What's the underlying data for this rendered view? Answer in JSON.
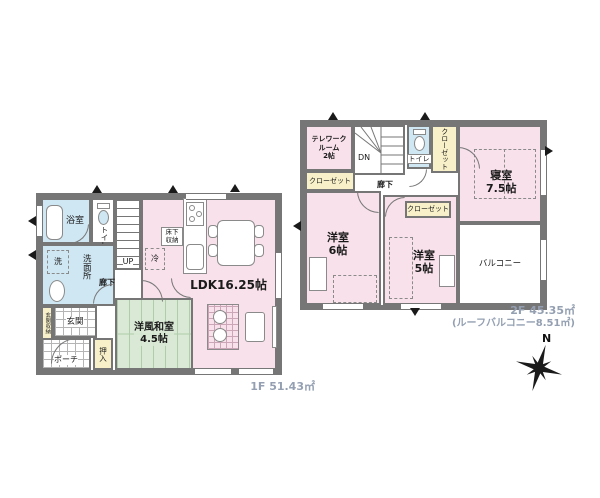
{
  "colors": {
    "wall": "#767676",
    "room_pink": "#f8e1eb",
    "room_green": "#d9e9d5",
    "room_blue": "#cfe7f3",
    "room_yellow": "#f7f0c8"
  },
  "compass": {
    "label": "N"
  },
  "floor1": {
    "area_label": "1F 51.43㎡",
    "labels": {
      "ldk": "LDK16.25帖",
      "washitsu1": "洋風和室",
      "washitsu2": "4.5帖",
      "bath": "浴室",
      "toilet": "トイレ",
      "senmenjo": "洗面所",
      "washer": "洗",
      "genkan": "玄関",
      "genkan_storage": "玄関収納",
      "porch": "ポーチ",
      "oshiire": "押入",
      "corridor": "廊下",
      "stairs_up": "UP",
      "yukashita1": "床下",
      "yukashita2": "収納",
      "fridge": "冷"
    }
  },
  "floor2": {
    "area_label": "2F 45.35㎡",
    "roof_balcony": "(ルーフバルコニー8.51㎡)",
    "labels": {
      "telework1": "テレワーク",
      "telework2": "ルーム",
      "telework3": "2帖",
      "stairs_dn": "DN",
      "toilet": "トイレ",
      "closet_right": "クローゼット",
      "closet_left": "クローゼット",
      "closet_mid": "クローゼット",
      "bedroom1": "寝室",
      "bedroom2": "7.5帖",
      "corridor": "廊下",
      "west6_1": "洋室",
      "west6_2": "6帖",
      "west5_1": "洋室",
      "west5_2": "5帖",
      "balcony": "バルコニー"
    }
  }
}
